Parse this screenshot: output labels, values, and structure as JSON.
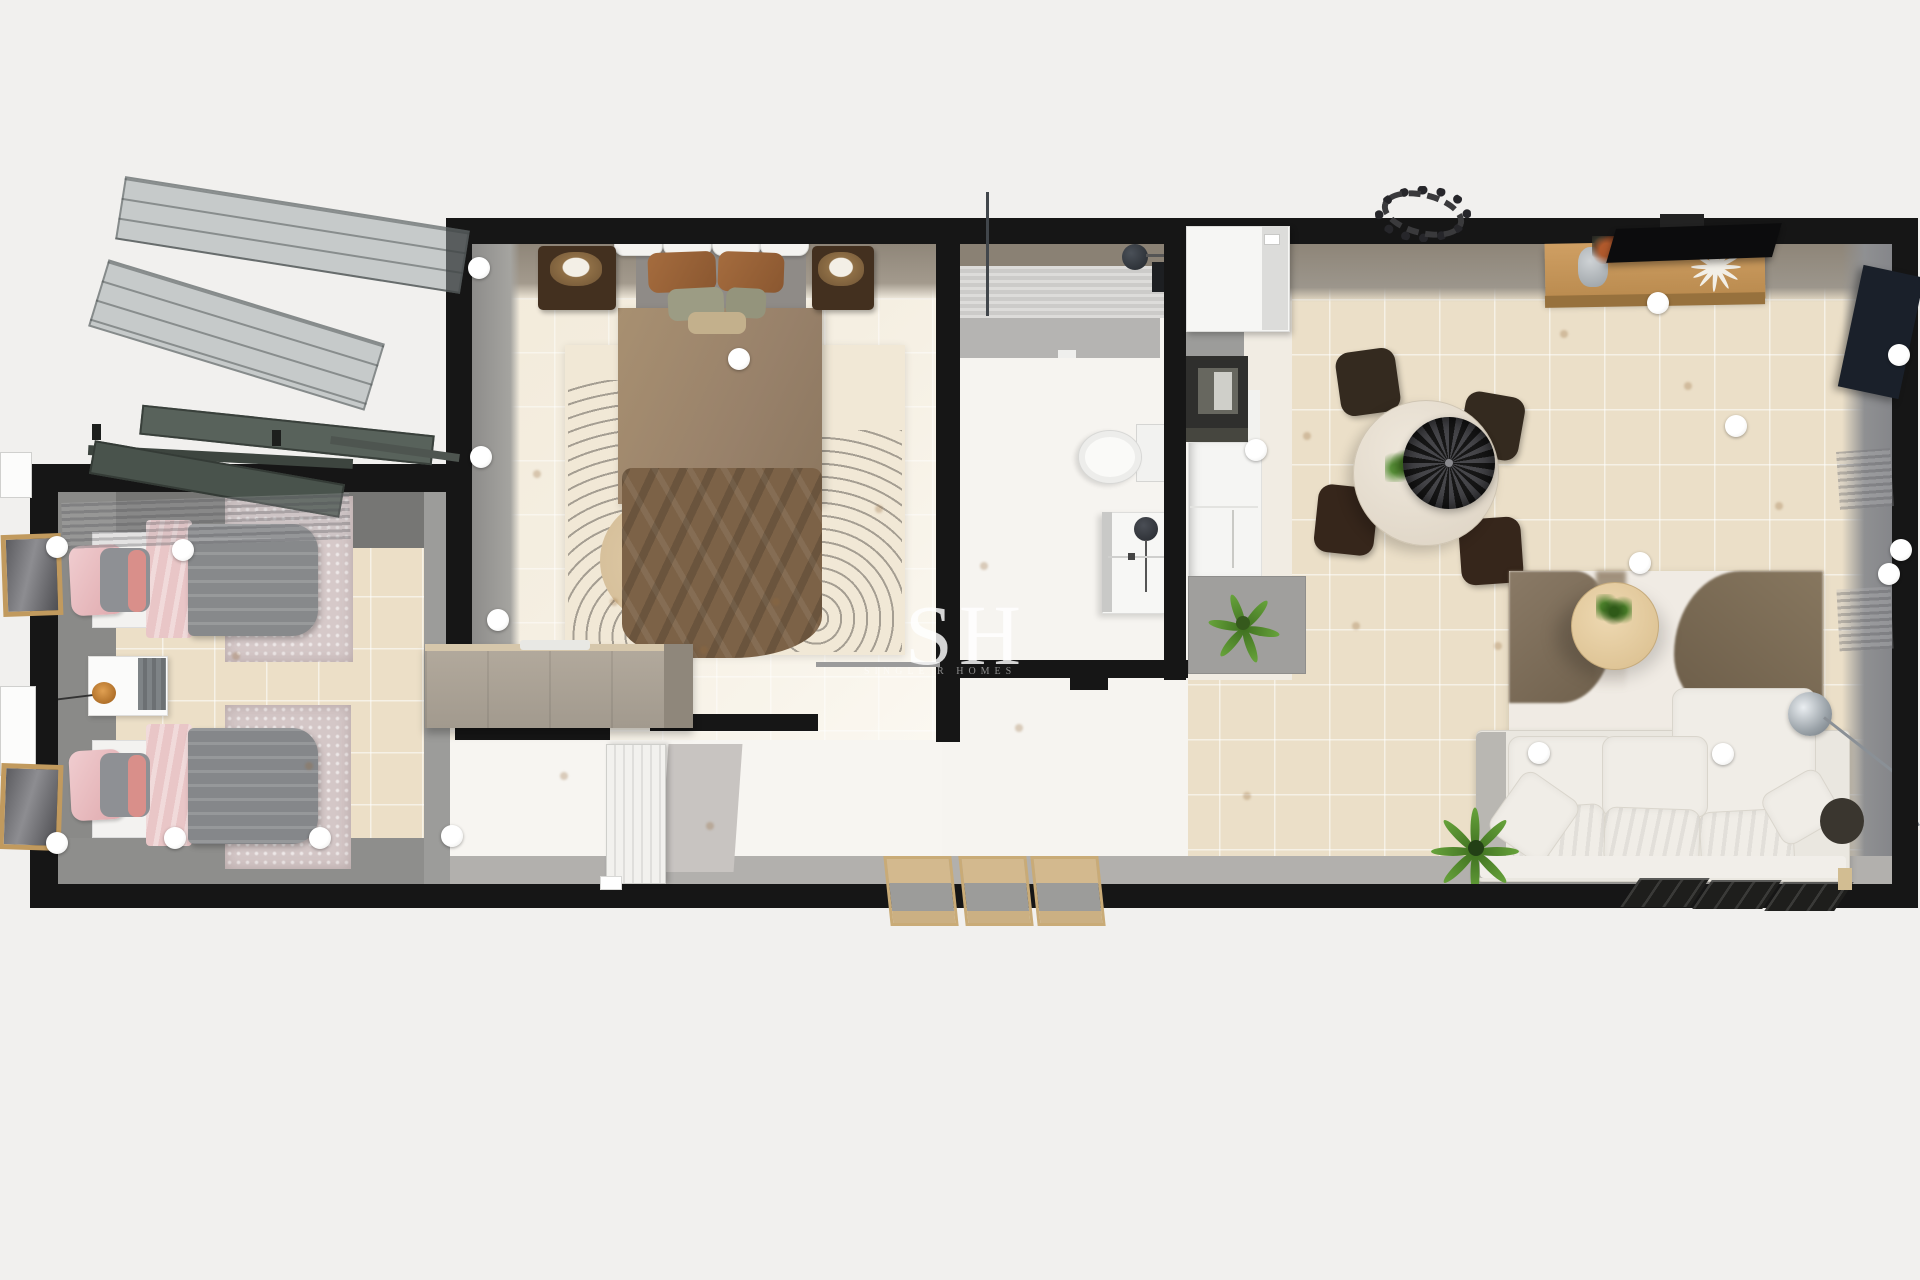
{
  "watermark": {
    "initials": "SH",
    "subtext": "SINGLE R HOMES"
  },
  "palette": {
    "background": "#f1f0ee",
    "wall_black": "#161616",
    "tile_beige": "#ebdfc8",
    "tile_cream": "#f2ead9",
    "floor_white": "#f6f4f1",
    "inner_wall_gray": "#8f8f8d",
    "wood": "#c79a60",
    "master_bed_brown": "#7c6247",
    "kids_bed_pink": "#e9c6c7",
    "kids_bed_gray": "#87898b",
    "sofa_cream": "#efece6",
    "dining_chair_brown": "#342a1f",
    "plant_green": "#5c8f33"
  },
  "camera_markers": {
    "count": 19
  }
}
